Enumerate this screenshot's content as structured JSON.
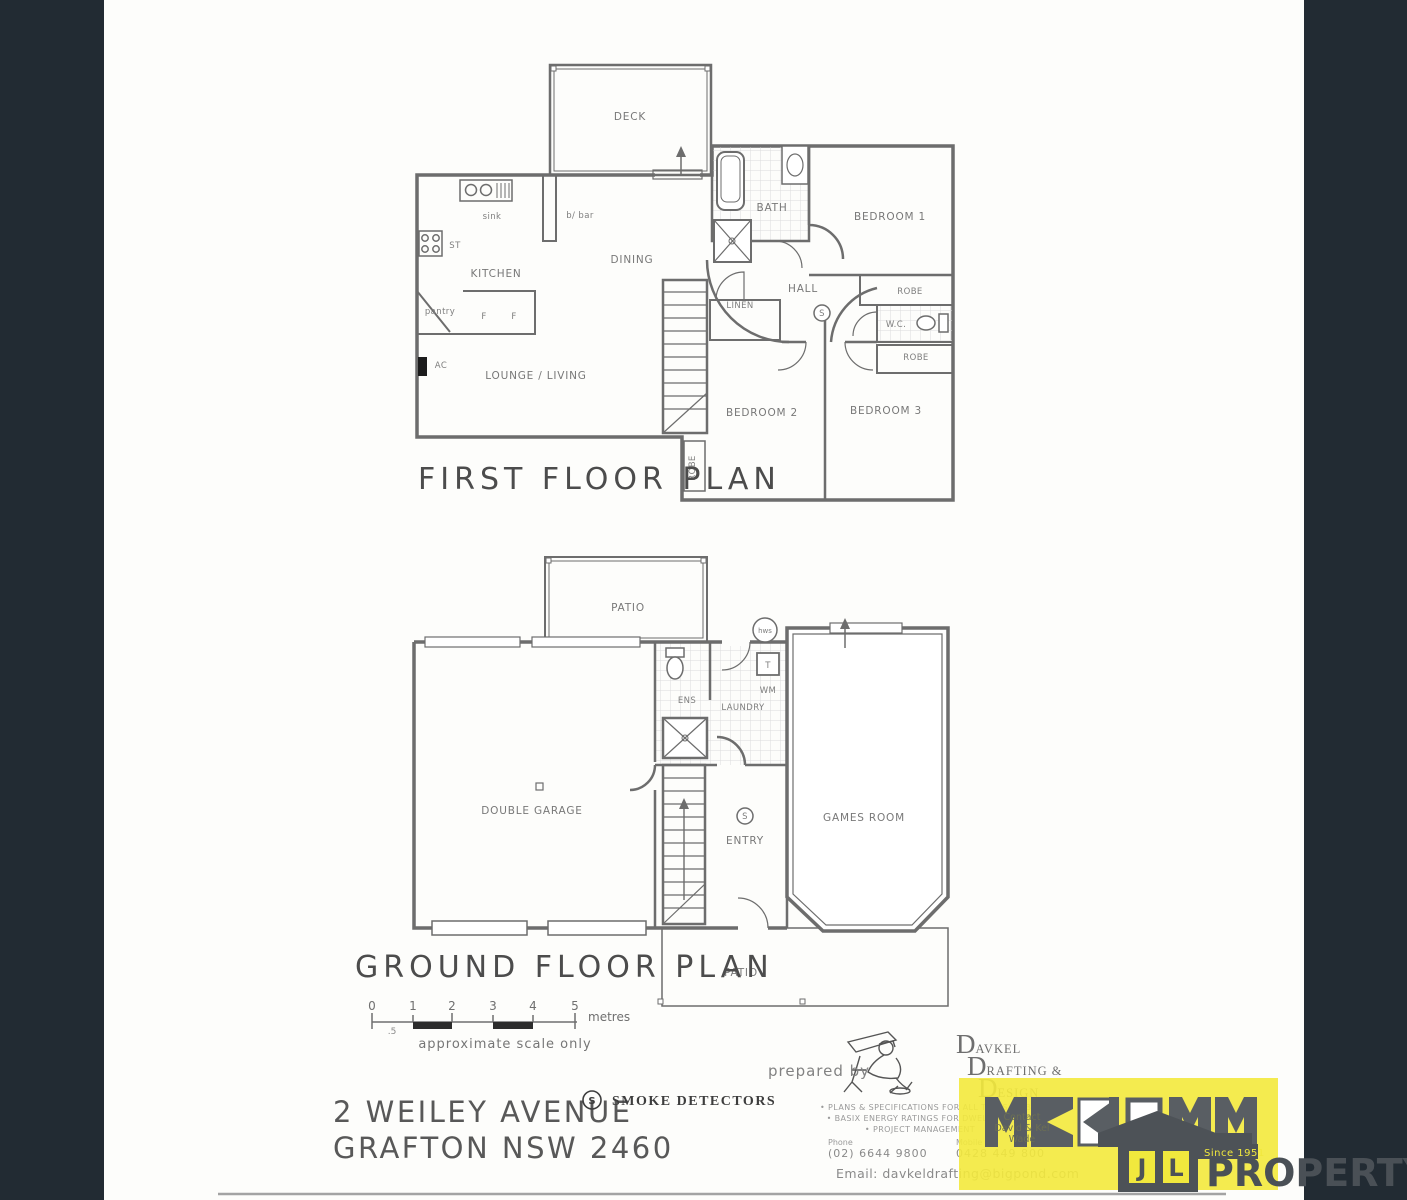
{
  "first_floor": {
    "title": "FIRST FLOOR PLAN",
    "rooms": {
      "deck": "DECK",
      "sink": "sink",
      "b_bar": "b/ bar",
      "st": "ST",
      "kitchen": "KITCHEN",
      "pantry": "pantry",
      "f1": "F",
      "f2": "F",
      "dining": "DINING",
      "bath": "BATH",
      "bedroom1": "BEDROOM 1",
      "hall": "HALL",
      "robe_top": "ROBE",
      "wc": "W.C.",
      "robe_mid": "ROBE",
      "linen": "LINEN",
      "bedroom2": "BEDROOM 2",
      "bedroom3": "BEDROOM 3",
      "robe_left": "ROBE",
      "lounge": "LOUNGE / LIVING",
      "ac": "AC",
      "smoke_symbol": "S"
    }
  },
  "ground_floor": {
    "title": "GROUND FLOOR PLAN",
    "rooms": {
      "patio_top": "PATIO",
      "hws": "hws",
      "ens": "ENS",
      "tub": "T",
      "wm": "WM",
      "laundry": "LAUNDRY",
      "garage": "DOUBLE GARAGE",
      "entry": "ENTRY",
      "games": "GAMES ROOM",
      "patio_bottom": "PATIO",
      "smoke_symbol": "S"
    }
  },
  "scale_bar": {
    "ticks": [
      "0",
      "1",
      "2",
      "3",
      "4",
      "5"
    ],
    "half_tick": ".5",
    "unit": "metres",
    "note": "approximate scale only"
  },
  "address": {
    "line1": "2 WEILEY AVENUE",
    "line2": "GRAFTON NSW 2460"
  },
  "legend": {
    "symbol": "S",
    "label": "SMOKE DETECTORS"
  },
  "prepared_by": {
    "label": "prepared by",
    "company_lines": [
      {
        "cap": "D",
        "rest": "AVKEL"
      },
      {
        "cap": "D",
        "rest": "RAFTING &"
      },
      {
        "cap": "D",
        "rest": "ESIGN"
      }
    ],
    "services": [
      "• PLANS & SPECIFICATIONS FOR ALL TYPES OF BUILDINGS",
      "• BASIX ENERGY RATINGS FOR DWELLINGS",
      "• PROJECT MANAGEMENT"
    ],
    "phone_label": "Phone",
    "phone": "(02) 6644 9800",
    "mobile_label": "Mobile",
    "mobile": "0428 449 800",
    "email": "Email: davkeldrafting@bigpond.com"
  },
  "brand": {
    "name": "MCKIMM",
    "since": "Since 1951",
    "jl_left": "J",
    "jl_right": "L",
    "property": "PROPERTY",
    "contact_lines": [
      "Contact",
      "David & Kel",
      "Wade"
    ],
    "yellow": "#f3e93c",
    "gray": "#595e63",
    "navy": "#222b33"
  }
}
